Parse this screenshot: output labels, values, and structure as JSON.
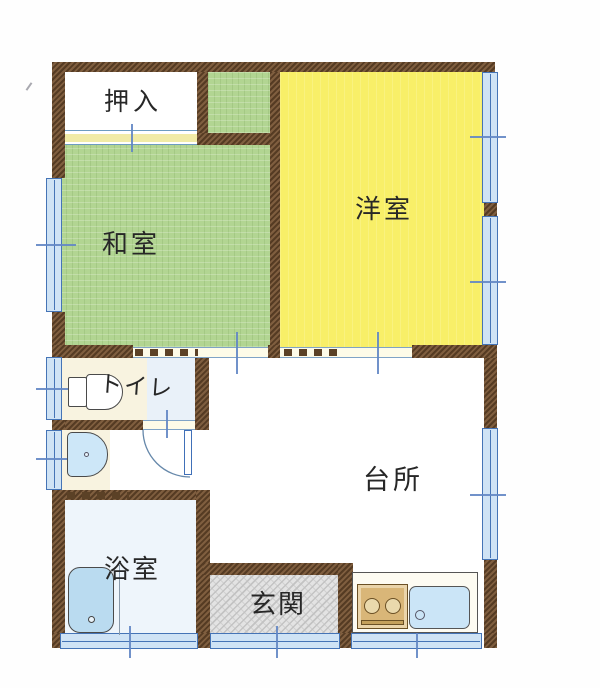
{
  "rooms": {
    "closet": {
      "label": "押入"
    },
    "japanese_room": {
      "label": "和室"
    },
    "western_room": {
      "label": "洋室"
    },
    "toilet": {
      "label": "トイレ"
    },
    "kitchen": {
      "label": "台所"
    },
    "bathroom": {
      "label": "浴室"
    },
    "entrance": {
      "label": "玄関"
    }
  },
  "fixtures": [
    "toilet",
    "washbasin",
    "bathtub",
    "stove-2-burner",
    "kitchen-sink",
    "swing-door",
    "sliding-doors",
    "windows",
    "entrance-door"
  ],
  "colors": {
    "wall_brown": "#6d4b2d",
    "tatami_green": "#b2d592",
    "western_room_yellow": "#f8ef68",
    "window_fill_blue": "#cfe3f5",
    "window_line_blue": "#4574b6",
    "entrance_gray": "#e3e3e3",
    "fixture_blue": "#badbf0",
    "stove_tan": "#d9b678",
    "track_cream": "#f1eba6"
  }
}
